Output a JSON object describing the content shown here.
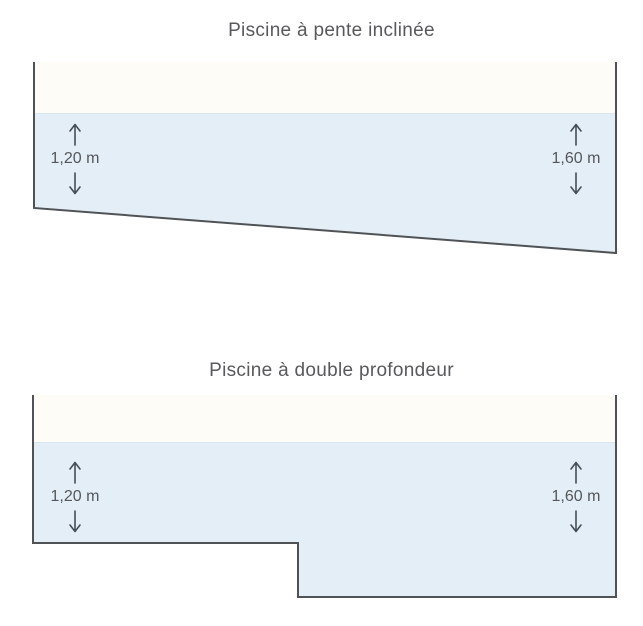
{
  "diagrams": [
    {
      "title": "Piscine à pente inclinée",
      "depth_left": "1,20 m",
      "depth_right": "1,60 m"
    },
    {
      "title": "Piscine à double profondeur",
      "depth_left": "1,20 m",
      "depth_right": "1,60 m"
    }
  ],
  "colors": {
    "water": "#e4eef6",
    "water_surface_line": "#d9e6f0",
    "pool_interior": "#fdfcf7",
    "outline": "#4f5356",
    "arrow": "#474e55",
    "text": "#58595b"
  }
}
